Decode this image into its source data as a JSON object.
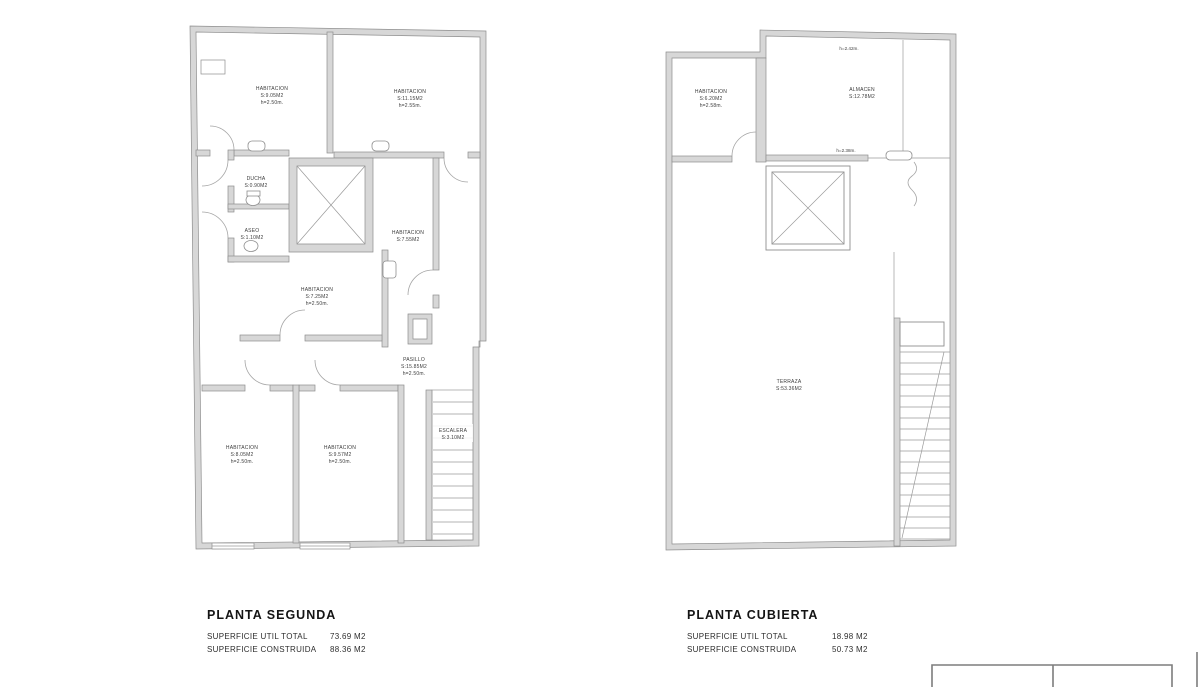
{
  "colors": {
    "background": "#ffffff",
    "wall_fill": "#d7d7d7",
    "line": "#8e8e8e",
    "label_text": "#3d3d3d",
    "title_text": "#141414"
  },
  "plans": [
    {
      "title": "PLANTA SEGUNDA",
      "summary": {
        "rows": [
          {
            "label": "SUPERFICIE UTIL TOTAL",
            "value": "73.69 M2"
          },
          {
            "label": "SUPERFICIE CONSTRUIDA",
            "value": "88.36 M2"
          }
        ]
      },
      "rooms": [
        {
          "name": "HABITACION",
          "area": "S:9.05M2",
          "height": "h=2.50m."
        },
        {
          "name": "HABITACION",
          "area": "S:11.15M2",
          "height": "h=2.55m."
        },
        {
          "name": "DUCHA",
          "area": "S:0.90M2"
        },
        {
          "name": "ASEO",
          "area": "S:1.10M2"
        },
        {
          "name": "HABITACION",
          "area": "S:7.55M2"
        },
        {
          "name": "HABITACION",
          "area": "S:7.25M2",
          "height": "h=2.50m."
        },
        {
          "name": "PASILLO",
          "area": "S:15.85M2",
          "height": "h=2.50m."
        },
        {
          "name": "ESCALERA",
          "area": "S:3.10M2"
        },
        {
          "name": "HABITACION",
          "area": "S:8.05M2",
          "height": "h=2.50m."
        },
        {
          "name": "HABITACION",
          "area": "S:9.57M2",
          "height": "h=2.50m."
        }
      ]
    },
    {
      "title": "PLANTA CUBIERTA",
      "summary": {
        "rows": [
          {
            "label": "SUPERFICIE UTIL TOTAL",
            "value": "18.98 M2"
          },
          {
            "label": "SUPERFICIE CONSTRUIDA",
            "value": "50.73 M2"
          }
        ]
      },
      "rooms": [
        {
          "name": "HABITACION",
          "area": "S:6.20M2",
          "height": "h=2.58m."
        },
        {
          "name": "ALMACEN",
          "area": "S:12.78M2"
        },
        {
          "name": "TERRAZA",
          "area": "S:53.36M2"
        }
      ],
      "notes": [
        "h=2.42m.",
        "h=2.38m."
      ]
    }
  ]
}
